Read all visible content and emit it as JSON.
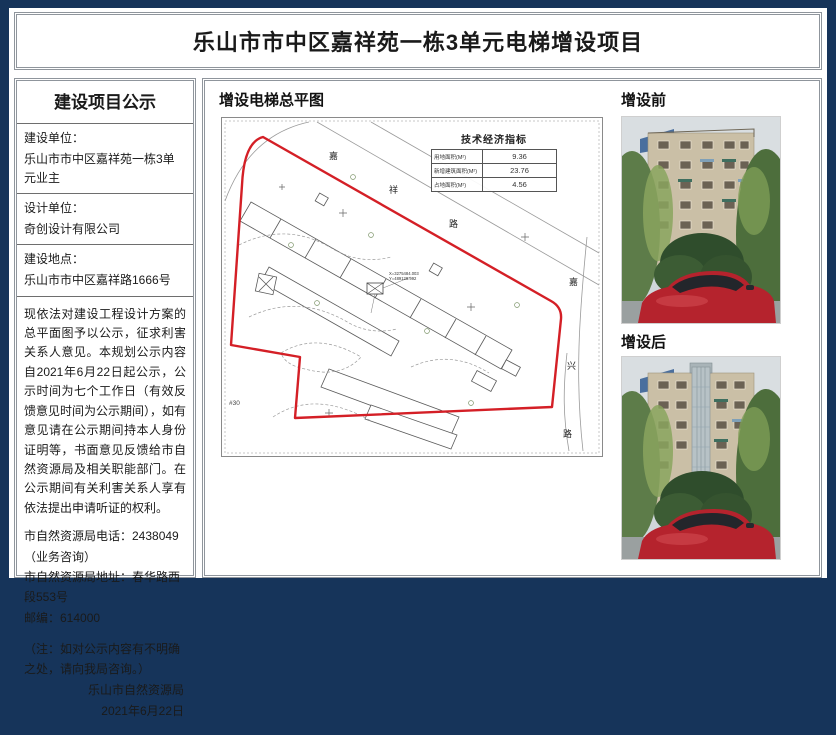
{
  "page": {
    "title": "乐山市市中区嘉祥苑一栋3单元电梯增设项目"
  },
  "notice": {
    "heading": "建设项目公示",
    "fields": [
      {
        "label": "建设单位：",
        "value": "乐山市市中区嘉祥苑一栋3单元业主"
      },
      {
        "label": "设计单位：",
        "value": "奇创设计有限公司"
      },
      {
        "label": "建设地点：",
        "value": "乐山市市中区嘉祥路1666号"
      }
    ],
    "body": "现依法对建设工程设计方案的总平面图予以公示，征求利害关系人意见。本规划公示内容自2021年6月22日起公示，公示时间为七个工作日（有效反馈意见时间为公示期间），如有意见请在公示期间持本人身份证明等，书面意见反馈给市自然资源局及相关职能部门。在公示期间有关利害关系人享有依法提出申请听证的权利。",
    "contact_lines": [
      "市自然资源局电话：2438049（业务咨询）",
      "市自然资源局地址：春华路西段553号",
      "邮编：614000"
    ],
    "note": "（注：如对公示内容有不明确之处，请向我局咨询。）",
    "signature": "乐山市自然资源局",
    "date": "2021年6月22日"
  },
  "plan": {
    "heading": "增设电梯总平图",
    "indicator_table": {
      "title": "技术经济指标",
      "rows": [
        {
          "label": "用地面积(M²)",
          "value": "9.36"
        },
        {
          "label": "新增建筑面积(M²)",
          "value": "23.76"
        },
        {
          "label": "占地面积(M²)",
          "value": "4.56"
        }
      ]
    },
    "road_labels": {
      "top": [
        "嘉",
        "祥",
        "路"
      ],
      "right": [
        "嘉",
        "兴",
        "路"
      ]
    },
    "annotations": {
      "coord_x": "X=3275484.003",
      "coord_y": "Y=489128.992",
      "house": "#30"
    }
  },
  "photos": {
    "before_label": "增设前",
    "after_label": "增设后"
  },
  "colors": {
    "frame": "#16345a",
    "boundary_red": "#d41f26",
    "car_red": "#b5232d"
  }
}
